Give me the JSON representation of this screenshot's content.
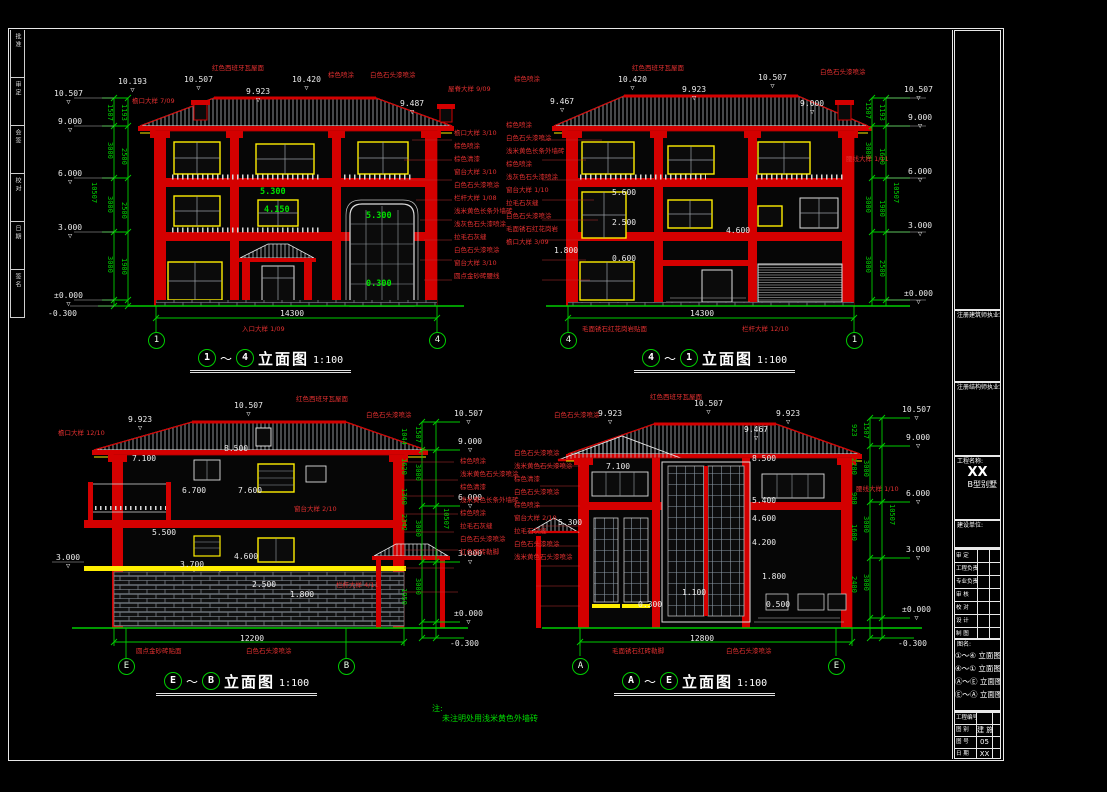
{
  "sheet": {
    "colors": {
      "line_green": "#00cc00",
      "line_red": "#d40000",
      "accent_yellow": "#ffee00",
      "background": "#000000"
    },
    "note_label": "注:",
    "note_text": "未注明处用浅米黄色外墙砖",
    "left_strip": [
      "批准",
      "审定",
      "会签",
      "校对",
      "日期",
      "签名"
    ],
    "right_panel": {
      "seal_arch": "注册建筑师执业章",
      "seal_struct": "注册结构师执业章",
      "project_label": "工程名称:",
      "project_name": "XX",
      "project_type": "B型别墅",
      "client_label": "建设单位:",
      "signoffs": [
        "审 定",
        "工程负责人",
        "专业负责人",
        "审 核",
        "校 对",
        "设 计",
        "制 图"
      ],
      "dwgname_label": "图名:",
      "dwg_names": [
        "①～④ 立面图",
        "④～① 立面图",
        "Ⓐ～Ⓔ 立面图",
        "Ⓔ～Ⓐ 立面图"
      ],
      "footer": [
        {
          "label": "工程编号",
          "value": ""
        },
        {
          "label": "图  别",
          "value": "建 施"
        },
        {
          "label": "图  号",
          "value": "05"
        },
        {
          "label": "日  期",
          "value": "XX"
        }
      ]
    }
  },
  "e1": {
    "title": {
      "from": "1",
      "to": "4",
      "label": "立面图",
      "scale": "1:100"
    },
    "grid_left": "1",
    "grid_right": "4",
    "top_dims": [
      "10.193",
      "10.507",
      "9.923",
      "10.420",
      "9.487"
    ],
    "roof_label": "红色西班牙瓦屋面",
    "top_callouts": [
      "棕色喷涂",
      "白色石头漆喷涂"
    ],
    "eave_callout": "檐口大样 7/09",
    "ridge_callout": "屋脊大样 9/09",
    "levels": [
      "10.507",
      "9.000",
      "6.000",
      "3.000",
      "±0.000",
      "-0.300"
    ],
    "dim_chain": [
      "1507",
      "3000",
      "3000",
      "3000",
      "300"
    ],
    "dim_chain_inner": [
      "314",
      "1193",
      "500",
      "2500",
      "500",
      "2500",
      "500",
      "1900",
      "600",
      "300"
    ],
    "dim_overall": "10507",
    "values": [
      "5.300",
      "4.150",
      "5.300",
      "0.300"
    ],
    "bottom_dim": "14300",
    "entry_callout": "入口大样 1/09",
    "callouts_right": [
      "檐口大样 3/10",
      "棕色喷涂",
      "棕色清漆",
      "窗台大样 3/10",
      "白色石头漆喷涂",
      "栏杆大样 1/08",
      "浅米黄色长条外墙砖",
      "浅灰色石头漆喷涂",
      "拉毛石灰缝",
      "白色石头漆喷涂",
      "窗台大样 3/10",
      "圆点金砂砖腰线"
    ]
  },
  "e2": {
    "title": {
      "from": "4",
      "to": "1",
      "label": "立面图",
      "scale": "1:100"
    },
    "grid_left": "4",
    "grid_right": "1",
    "top_dims": [
      "9.467",
      "10.420",
      "9.923",
      "10.507",
      "9.000"
    ],
    "roof_label": "红色西班牙瓦屋面",
    "top_callouts": [
      "棕色喷涂",
      "白色石头漆喷涂"
    ],
    "levels": [
      "10.507",
      "9.000",
      "6.000",
      "3.000",
      "±0.000"
    ],
    "dim_chain": [
      "1507",
      "3000",
      "3000",
      "3000",
      "100"
    ],
    "dim_chain_inner": [
      "314",
      "1193",
      "600",
      "1600",
      "500",
      "1900",
      "600",
      "500",
      "2500",
      "300"
    ],
    "dim_overall": "10507",
    "values": [
      "5.600",
      "2.500",
      "0.600",
      "1.800",
      "4.600"
    ],
    "bottom_dim": "14300",
    "waist_callout": "腰线大样 1/11",
    "rail_callout": "栏杆大样 12/10",
    "base_callout": "毛面锈石红花岗岩贴面",
    "callouts_left": [
      "棕色喷涂",
      "白色石头漆喷涂",
      "浅米黄色长条外墙砖",
      "棕色喷涂",
      "浅灰色石头漆喷涂",
      "窗台大样 1/10",
      "拉毛石灰缝",
      "白色石头漆喷涂",
      "毛面锈石红花岗岩",
      "檐口大样 3/09"
    ]
  },
  "e3": {
    "title": {
      "from": "E",
      "to": "B",
      "label": "立面图",
      "scale": "1:100"
    },
    "grid_left": "E",
    "grid_right": "B",
    "top_dims": [
      "9.923",
      "10.507"
    ],
    "roof_label": "红色西班牙瓦屋面",
    "top_callout": "白色石头漆喷涂",
    "eave_callout": "檐口大样 12/10",
    "left_level": "3.000",
    "levels": [
      "10.507",
      "9.000",
      "6.000",
      "3.000",
      "±0.000",
      "-0.300"
    ],
    "dim_chain": [
      "1507",
      "3000",
      "3000",
      "3000",
      "300"
    ],
    "dim_chain_inner": [
      "463",
      "1044",
      "1620",
      "1360",
      "2342",
      "858",
      "1050",
      "1950",
      "300"
    ],
    "dim_overall": "10507",
    "values": [
      "7.100",
      "8.500",
      "6.700",
      "7.600",
      "5.500",
      "3.700",
      "4.600",
      "2.500",
      "1.800"
    ],
    "bottom_dim": "12200",
    "window_callout": "窗台大样 2/10",
    "rail_callout": "栏杆大样 4/11",
    "bottom_callouts": [
      "圆点金砂砖贴面",
      "白色石头漆喷涂"
    ],
    "callouts_right": [
      "棕色喷涂",
      "浅米黄色石头漆喷涂",
      "棕色清漆",
      "浅米黄色长条外墙砖",
      "棕色喷涂",
      "拉毛石灰缝",
      "白色石头漆喷涂",
      "红色面砖勒脚"
    ]
  },
  "e4": {
    "title": {
      "from": "A",
      "to": "E",
      "label": "立面图",
      "scale": "1:100"
    },
    "grid_left": "A",
    "grid_right": "E",
    "top_dims": [
      "9.923",
      "10.507",
      "9.923"
    ],
    "extra_top_dim": "9.467",
    "roof_label": "红色西班牙瓦屋面",
    "top_callout": "白色石头漆喷涂",
    "levels": [
      "10.507",
      "9.000",
      "6.000",
      "3.000",
      "±0.000",
      "-0.300"
    ],
    "dim_chain": [
      "1507",
      "3000",
      "3000",
      "3000",
      "300"
    ],
    "dim_chain_inner": [
      "164",
      "923",
      "800",
      "2200",
      "900",
      "600",
      "1600",
      "2400",
      "600",
      "300"
    ],
    "dim_overall": "10507",
    "values": [
      "7.100",
      "8.500",
      "5.400",
      "4.600",
      "4.200",
      "5.300",
      "1.800",
      "1.100",
      "0.300",
      "0.500"
    ],
    "bottom_dim": "12800",
    "waist_callout": "腰线大样 1/10",
    "bottom_callouts": [
      "毛面锈石红砖勒脚",
      "白色石头漆喷涂"
    ],
    "callouts_left": [
      "白色石头漆喷涂",
      "浅米黄色石头漆喷涂",
      "棕色清漆",
      "白色石头漆喷涂",
      "棕色喷涂",
      "窗台大样 2/10",
      "拉毛石灰缝",
      "白色石头漆喷涂",
      "浅米黄色石头漆喷涂"
    ]
  }
}
